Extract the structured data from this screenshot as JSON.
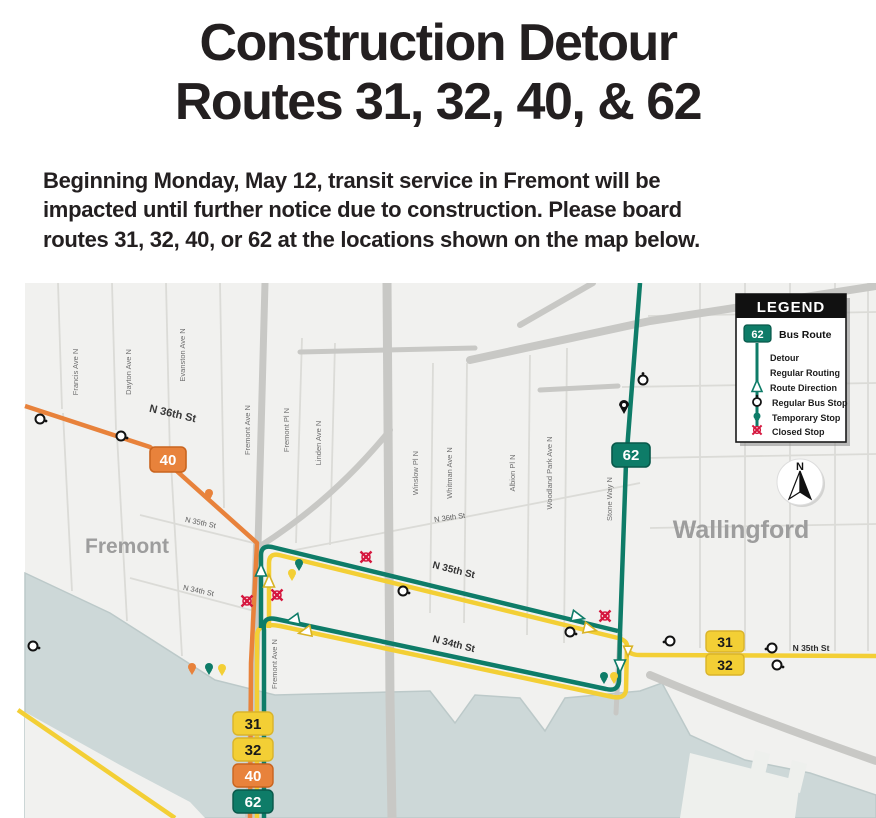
{
  "title": {
    "line1": "Construction Detour",
    "line2": "Routes 31, 32, 40, & 62"
  },
  "intro": {
    "line1": "Beginning Monday, May 12, transit service in Fremont will be",
    "line2": "impacted until further notice due to construction. Please board",
    "line3": "routes 31, 32, 40, or 62 at the locations shown on the map below."
  },
  "legend": {
    "title": "LEGEND",
    "bus_route_badge": "62",
    "items": {
      "bus_route": "Bus Route",
      "detour": "Detour",
      "regular_routing": "Regular Routing",
      "route_direction": "Route Direction",
      "regular_bus_stop": "Regular Bus Stop",
      "temporary_stop": "Temporary Stop",
      "closed_stop": "Closed Stop"
    }
  },
  "compass": {
    "label": "N"
  },
  "routes": {
    "r31": "31",
    "r32": "32",
    "r40": "40",
    "r62": "62"
  },
  "map": {
    "neighborhoods": {
      "fremont": "Fremont",
      "wallingford": "Wallingford"
    },
    "streets": {
      "francis": "Francis Ave N",
      "dayton": "Dayton Ave N",
      "evanston": "Evanston Ave N",
      "fremont_ave": "Fremont Ave N",
      "fremont_pl": "Fremont Pl N",
      "linden": "Linden Ave N",
      "winslow": "Winslow Pl N",
      "whitman": "Whitman Ave N",
      "albion": "Albion Pl N",
      "woodland": "Woodland Park Ave N",
      "stone_way": "Stone Way N",
      "n36": "N 36th St",
      "n35": "N 35th St",
      "n34": "N 34th St"
    },
    "colors": {
      "route_40": "#E8823B",
      "route_62": "#0E7C68",
      "route_31_32": "#F3CF35",
      "closed_stop": "#D5173E",
      "water": "#CDD8D8"
    }
  }
}
